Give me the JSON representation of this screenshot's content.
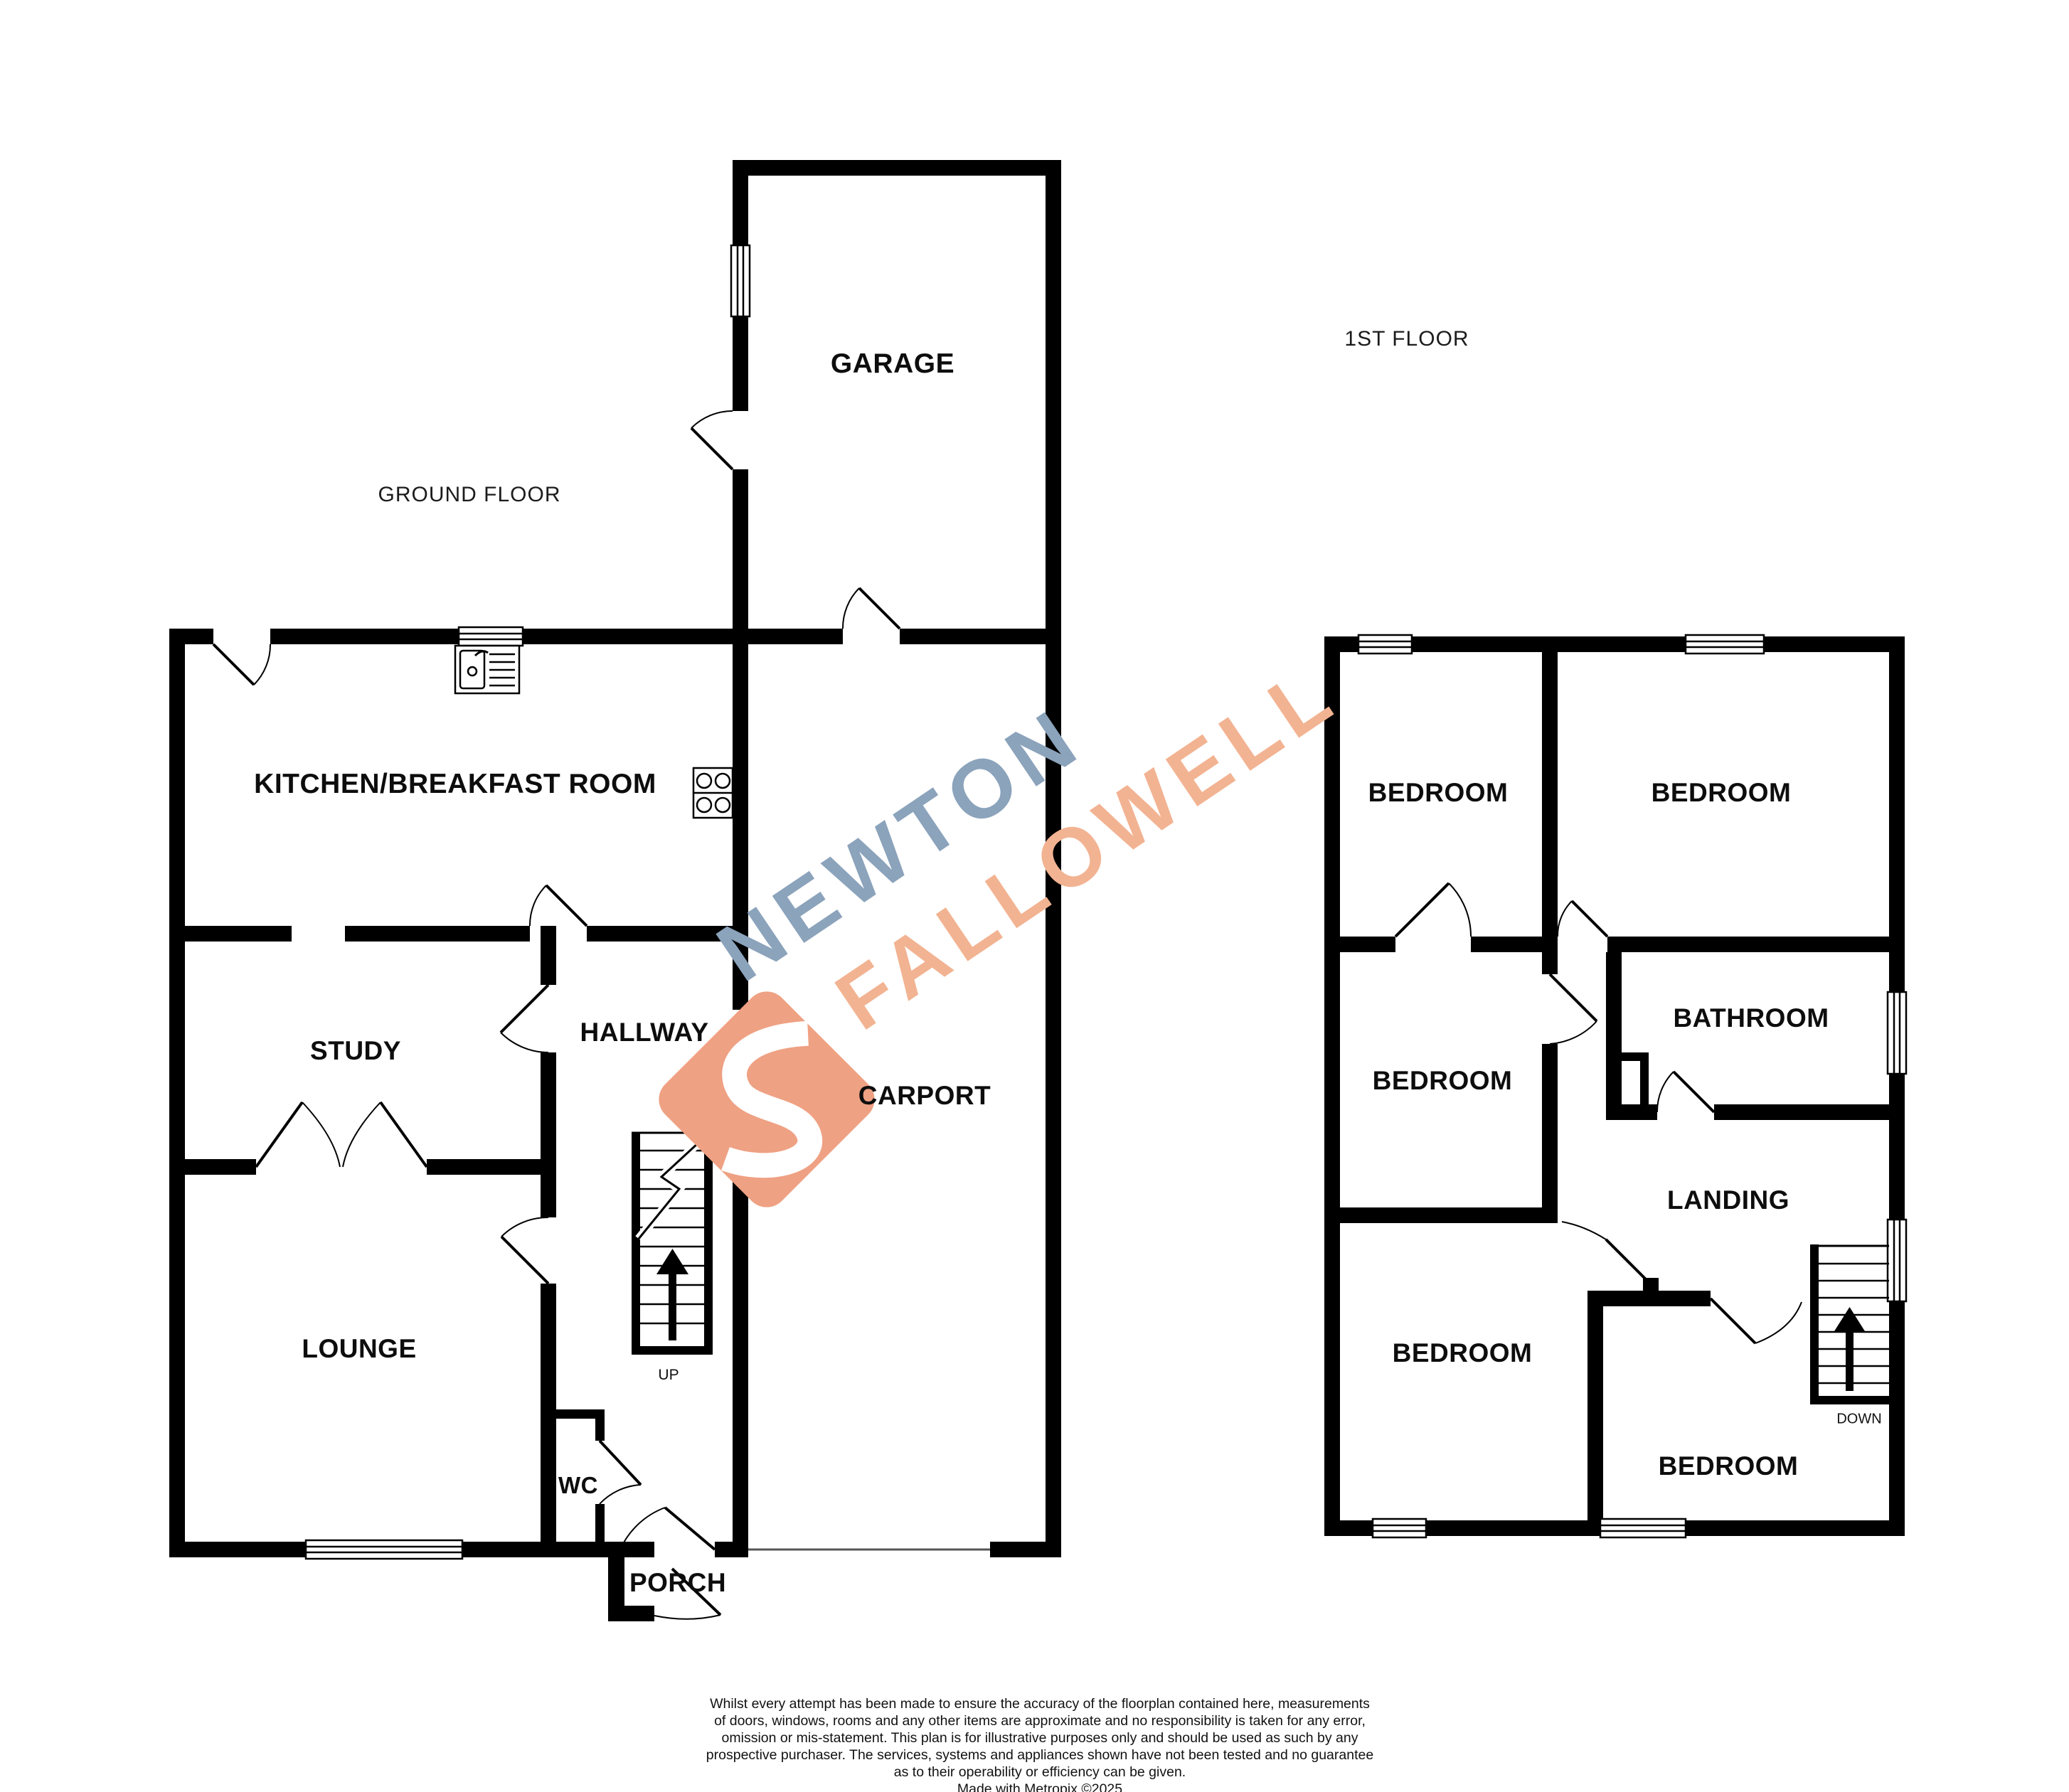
{
  "floors": {
    "ground": {
      "title": "GROUND FLOOR",
      "rooms": {
        "garage": "GARAGE",
        "kitchen": "KITCHEN/BREAKFAST ROOM",
        "study": "STUDY",
        "hallway": "HALLWAY",
        "carport": "CARPORT",
        "lounge": "LOUNGE",
        "wc": "WC",
        "porch": "PORCH"
      },
      "stairs_label": "UP"
    },
    "first": {
      "title": "1ST FLOOR",
      "rooms": {
        "bedroom_top_left": "BEDROOM",
        "bedroom_top_right": "BEDROOM",
        "bedroom_mid_left": "BEDROOM",
        "bathroom": "BATHROOM",
        "landing": "LANDING",
        "bedroom_bottom_left": "BEDROOM",
        "bedroom_bottom_right": "BEDROOM"
      },
      "stairs_label": "DOWN"
    }
  },
  "watermark": {
    "line1": "NEWTON",
    "line2": "FALLOWELL",
    "colors": {
      "line1": "#8BA3BB",
      "line2": "#F2B392",
      "logo": "#EFA183"
    }
  },
  "icons": {
    "sink": "kitchen-sink-icon",
    "hob": "cooker-hob-icon",
    "up_arrow": "stairs-up-arrow-icon",
    "down_arrow": "stairs-down-arrow-icon",
    "logo": "newton-fallowell-s-logo-icon"
  },
  "disclaimer": {
    "lines": [
      "Whilst every attempt has been made to ensure the accuracy of the floorplan contained here, measurements",
      "of doors, windows, rooms and any other items are approximate and no responsibility is taken for any error,",
      "omission or mis-statement. This plan is for illustrative purposes only and should be used as such by any",
      "prospective purchaser. The services, systems and appliances shown have not been tested and no guarantee",
      "as to their operability or efficiency can be given.",
      "Made with Metropix ©2025"
    ]
  }
}
